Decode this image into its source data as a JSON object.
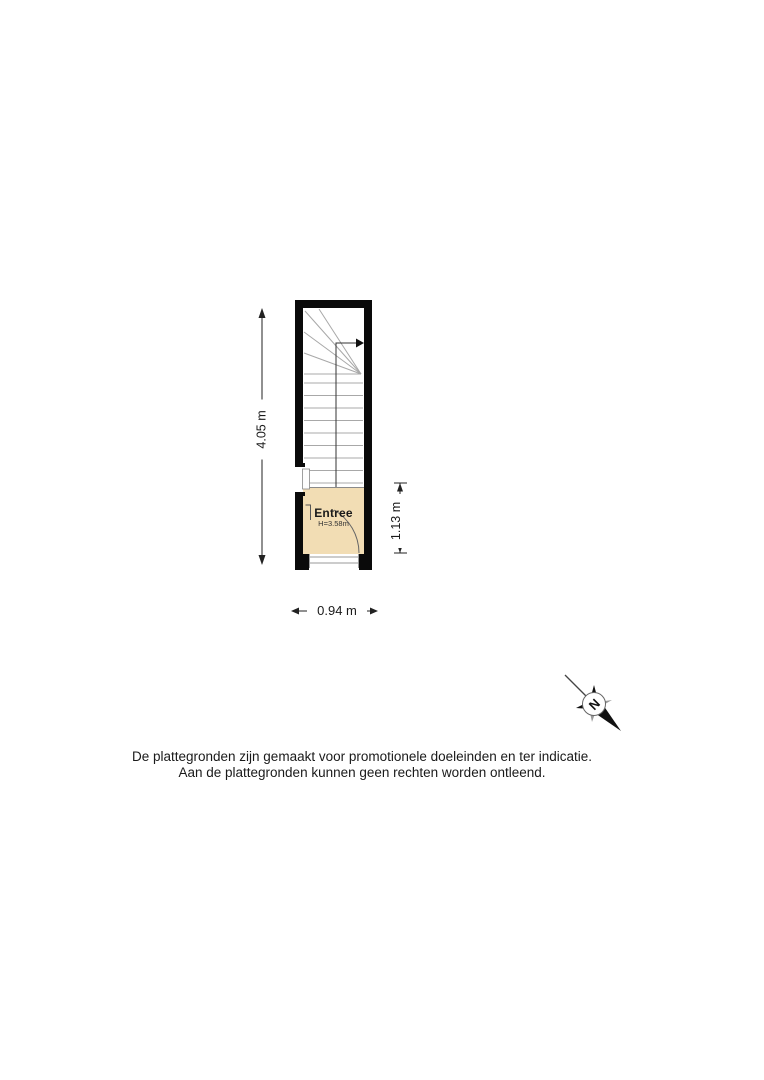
{
  "floorplan": {
    "room": {
      "name": "Entree",
      "ceiling_height": "H=3.58m"
    },
    "dimensions": {
      "total_depth": "4.05 m",
      "entree_depth": "1.13 m",
      "width": "0.94 m"
    },
    "compass": {
      "north": "N"
    },
    "disclaimer": {
      "line1": "De plattegronden zijn gemaakt voor promotionele doeleinden en ter indicatie.",
      "line2": "Aan de plattegronden kunnen geen rechten worden ontleend."
    },
    "colors": {
      "wall": "#0a0a0a",
      "floor_fill": "#f2ddb4",
      "stair_line": "#a8a8a8",
      "text": "#1a1a1a"
    }
  }
}
